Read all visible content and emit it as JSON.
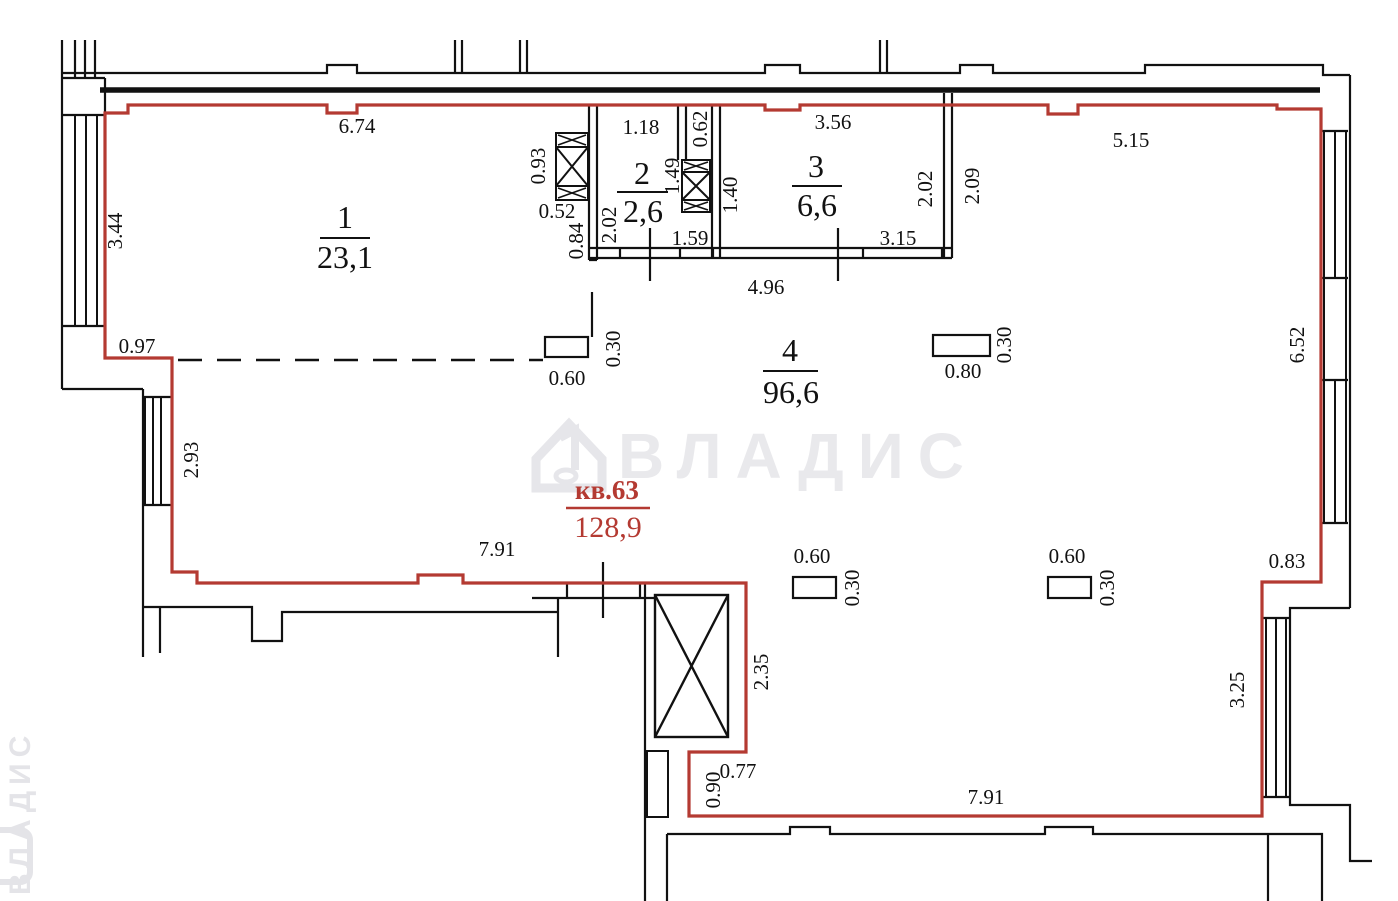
{
  "plan": {
    "apartment": {
      "label": "кв.63",
      "area": "128,9"
    },
    "watermark": {
      "brand": "ВЛАДИС",
      "side": "ВЛАДИС"
    },
    "rooms": [
      {
        "number": "1",
        "area": "23,1"
      },
      {
        "number": "2",
        "area": "2,6"
      },
      {
        "number": "3",
        "area": "6,6"
      },
      {
        "number": "4",
        "area": "96,6"
      }
    ],
    "dims": {
      "top_room1": "6.74",
      "left_upper": "3.44",
      "left_step": "0.97",
      "left_mid": "2.93",
      "mid_wall": "7.91",
      "shaft1_h": "0.93",
      "shaft1_w": "0.52",
      "room2_left_out": "0.84",
      "room2_left_in": "2.02",
      "room2_bottom": "1.59",
      "room2_top": "1.18",
      "shaft2_h": "1.49",
      "nook_top": "0.62",
      "room3_left": "1.40",
      "room3_top": "3.56",
      "room3_right_in": "2.02",
      "room3_right_out": "2.09",
      "room3_bottom": "3.15",
      "rooms23_bottom": "4.96",
      "top_room4": "5.15",
      "right_upper": "6.52",
      "right_step": "0.83",
      "right_lower": "3.25",
      "bottom": "7.91",
      "shaft3_right": "2.35",
      "bottom_step_w": "0.77",
      "bottom_step_h": "0.90",
      "col1_w": "0.60",
      "col1_h": "0.30",
      "col2_w": "0.80",
      "col2_h": "0.30",
      "col3_w": "0.60",
      "col3_h": "0.30",
      "col4_w": "0.60",
      "col4_h": "0.30"
    },
    "colors": {
      "boundary": "#b43a32",
      "walls": "#111111",
      "watermark": "#e9e9ec"
    }
  }
}
